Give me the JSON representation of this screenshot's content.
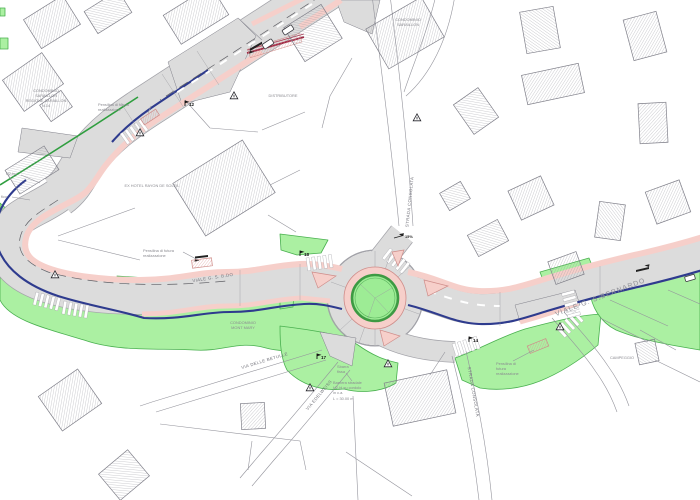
{
  "colors": {
    "road_fill": "#dcdcdc",
    "road_edge": "#a2a2a8",
    "sidewalk_pink": "#f6cfca",
    "pink_edge": "#cf8d8a",
    "curb_blue": "#2e3b8e",
    "line_green": "#2f9e3f",
    "green_area": "#abf0a2",
    "green_area_edge": "#49b04f",
    "island_green": "#9dec95",
    "island_ring": "#3d9a43",
    "hatch_line": "#94949c",
    "outline_grey": "#80808a",
    "text_grey": "#8a8a90",
    "median_red": "#a02945"
  },
  "labels": {
    "condominio_saraillon_left_l1": "CONDOMINIO",
    "condominio_saraillon_left_l2": "SARAILLON",
    "condominio_saraillon_left_l3": "REGIONE SARAILLON",
    "condominio_saraillon_left_l4": "N.14",
    "pensilina_top_l1": "Pensilina di futura",
    "pensilina_top_l2": "realizzazione",
    "distributore": "DISTRIBUTORE",
    "condominio_saraillon_top_l1": "CONDOMINIO",
    "condominio_saraillon_top_l2": "SARAILLON",
    "ex_hotel": "EX HOTEL RAYON DE SOLEIL",
    "guardrail_left": "H2-bo",
    "left_partial": "fico",
    "pensilina_mid_l1": "Pensilina di futura",
    "pensilina_mid_l2": "realizzazione",
    "viale_bdo": "VIALE G. S. B.DO",
    "condominio_mont_mary_l1": "CONDOMINIO",
    "condominio_mont_mary_l2": "MONT MARY",
    "via_delle_betulle": "VIA DELLE BETULLE",
    "via_edelweiss": "VIA EDELWEISS",
    "strada_consolata_top": "STRADA CONSOLATA",
    "strada_consolata_south": "STRADA CONSOLATA",
    "sbarra_l1": "Sbarra",
    "sbarra_l2": "fissa",
    "barriera_l1": "Barriera stradale",
    "barriera_l2": "H2-bl su cordolo",
    "barriera_l3": "in c.a.",
    "barriera_l4": "L = 30.00 m",
    "pensilina_right_l1": "Pensilina di",
    "pensilina_right_l2": "futura",
    "pensilina_right_l3": "realizzazione",
    "viale_bernardo": "VIALE G. S.BERNARDO",
    "campeggio": "CAMPEGGIO",
    "slope": "15%",
    "m12": "12",
    "m18": "18",
    "m17": "17",
    "m14": "14"
  }
}
